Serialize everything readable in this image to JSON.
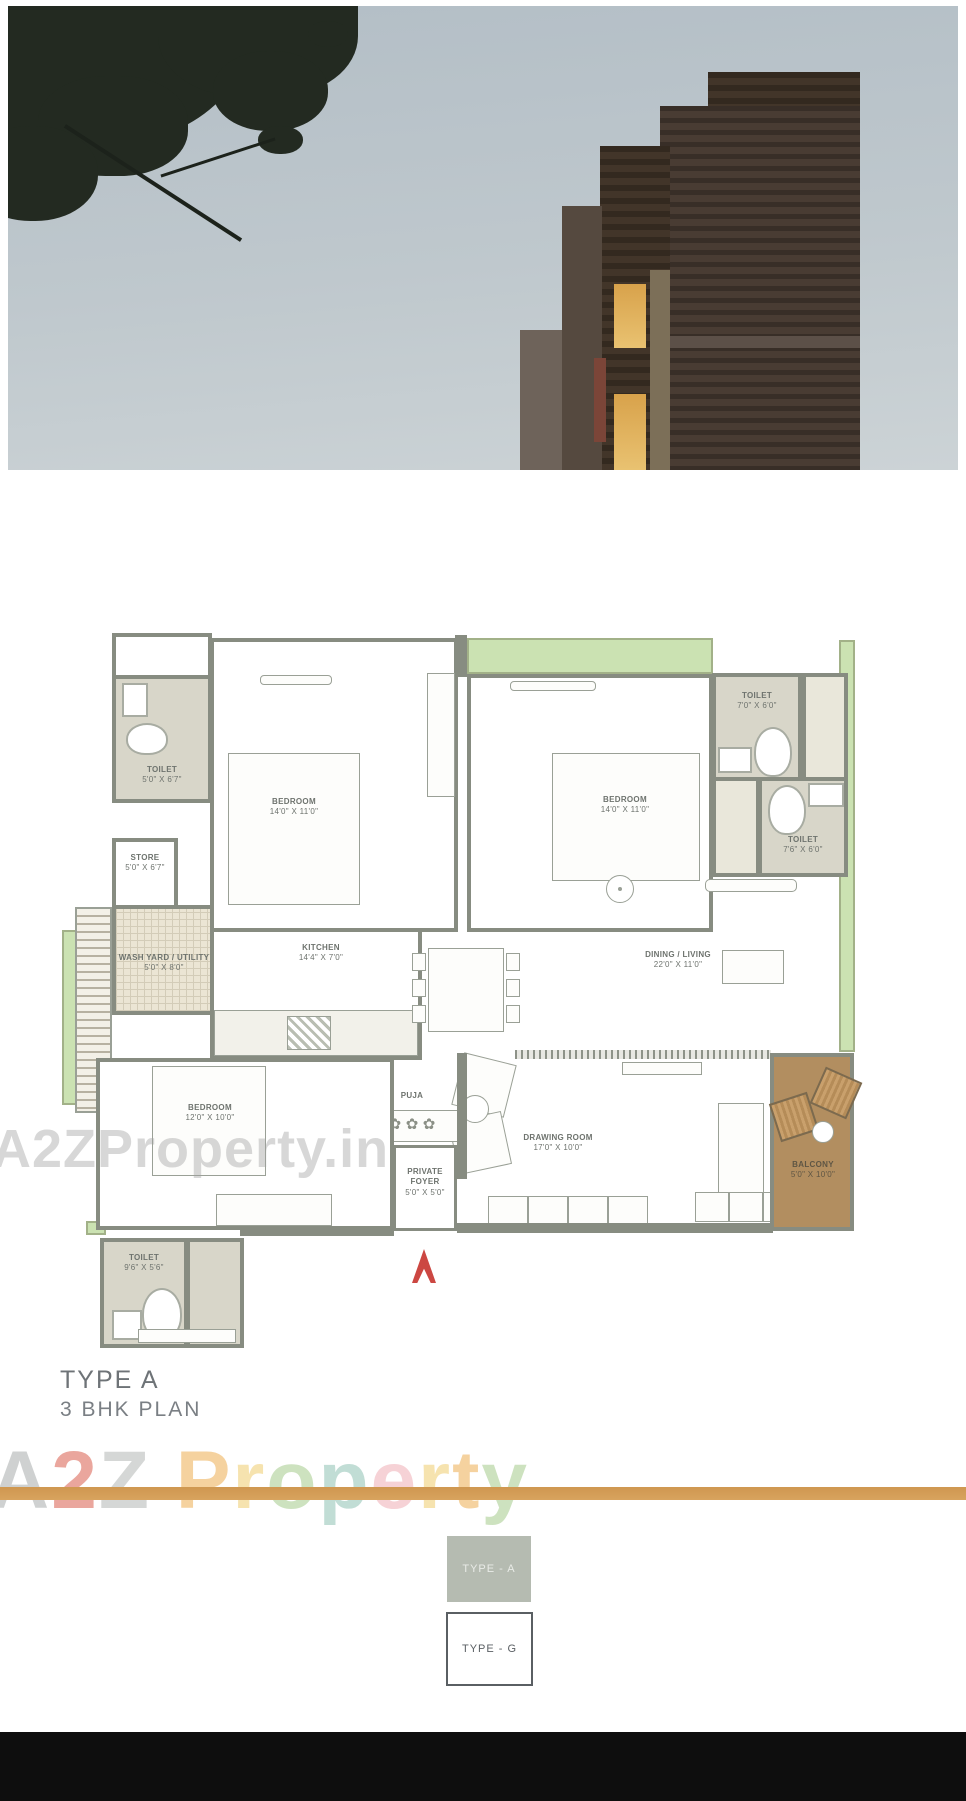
{
  "plan_title": {
    "line1": "TYPE A",
    "line2": "3 BHK PLAN"
  },
  "rooms": {
    "toilet_tl": {
      "name": "TOILET",
      "dim": "5'0\" X 6'7\""
    },
    "store": {
      "name": "STORE",
      "dim": "5'0\" X 6'7\""
    },
    "wash": {
      "name": "WASH YARD / UTILITY",
      "dim": "5'0\" X 8'0\""
    },
    "bedroom1": {
      "name": "BEDROOM",
      "dim": "14'0\" X 11'0\""
    },
    "bedroom2": {
      "name": "BEDROOM",
      "dim": "14'0\" X 11'0\""
    },
    "toilet_tr1": {
      "name": "TOILET",
      "dim": "7'0\" X 6'0\""
    },
    "toilet_tr2": {
      "name": "TOILET",
      "dim": "7'6\" X 6'0\""
    },
    "kitchen": {
      "name": "KITCHEN",
      "dim": "14'4\" X 7'0\""
    },
    "dining": {
      "name": "DINING / LIVING",
      "dim": "22'0\" X 11'0\""
    },
    "bedroom3": {
      "name": "BEDROOM",
      "dim": "12'0\" X 10'0\""
    },
    "puja": {
      "name": "PUJA"
    },
    "drawing": {
      "name": "DRAWING ROOM",
      "dim": "17'0\" X 10'0\""
    },
    "foyer": {
      "name": "PRIVATE FOYER",
      "dim": "5'0\" X 5'0\""
    },
    "balcony": {
      "name": "BALCONY",
      "dim": "5'0\" X 10'0\""
    },
    "toilet_bl": {
      "name": "TOILET",
      "dim": "9'6\" X 5'6\""
    }
  },
  "icons": {
    "flower": "✿"
  },
  "watermark": {
    "plan_text": "A2ZProperty.in",
    "footer_letters": [
      {
        "ch": "A",
        "c": "#a9adad"
      },
      {
        "ch": "2",
        "c": "#d95f4e"
      },
      {
        "ch": "Z",
        "c": "#b4b8b6"
      },
      {
        "ch": " ",
        "c": "#ffffff"
      },
      {
        "ch": "P",
        "c": "#edae52"
      },
      {
        "ch": "r",
        "c": "#f0cd6e"
      },
      {
        "ch": "o",
        "c": "#a5cc8c"
      },
      {
        "ch": "p",
        "c": "#8fc2b4"
      },
      {
        "ch": "e",
        "c": "#f0aeb6"
      },
      {
        "ch": "r",
        "c": "#f0cd6e"
      },
      {
        "ch": "t",
        "c": "#edae52"
      },
      {
        "ch": "y",
        "c": "#a5cc8c"
      }
    ]
  },
  "footer": {
    "button_a": "TYPE - A",
    "button_g": "TYPE - G"
  },
  "colors": {
    "green_strip": "#cbe2b2",
    "balcony_floor": "#b28e60",
    "wall": "#878c81",
    "rule_orange": "#d29a56",
    "entrance_arrow_red": "#cc4742",
    "footer_bar": "#0e0e0e"
  }
}
